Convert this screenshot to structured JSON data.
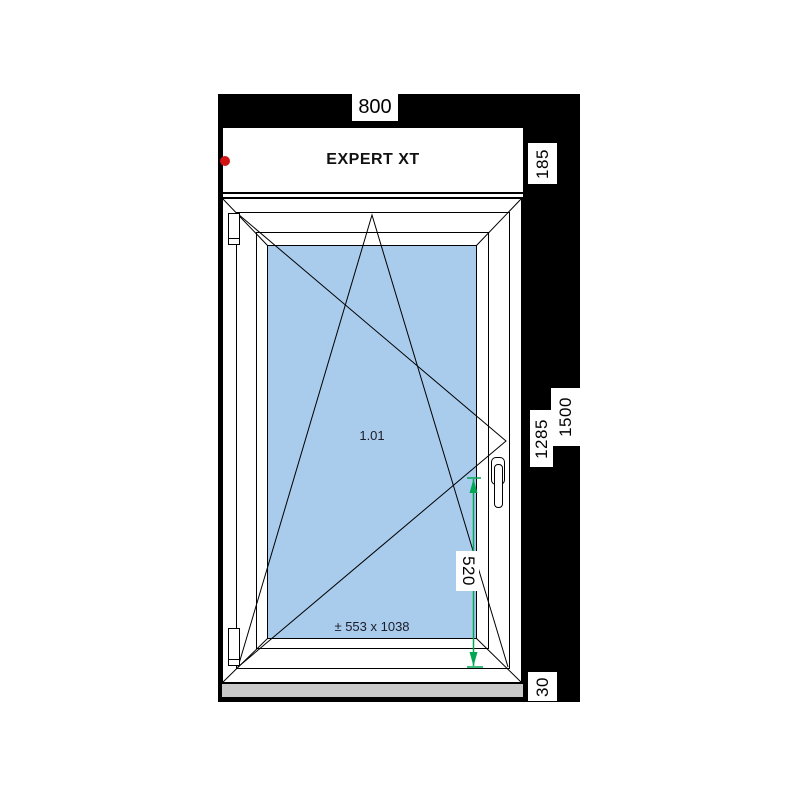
{
  "drawing": {
    "profile_name": "EXPERT XT",
    "position_number": "1.01",
    "glass_size_label": "± 553 x 1038"
  },
  "dimensions": {
    "frame_width": "800",
    "top_box_height": "185",
    "total_height": "1500",
    "window_height": "1285",
    "handle_height": "520",
    "sill_height": "30"
  },
  "icons": {
    "marker": "red-dot",
    "handle": "window-handle",
    "hinges": "hinge-plates",
    "opening_symbols": "tilt-and-turn-lines",
    "green_dimension": "handle-height-arrow"
  },
  "colors": {
    "glass": "#A9CBEC",
    "masonry": "#000000",
    "sill": "#C9C9C9",
    "marker_dot": "#D11414",
    "dimension_green": "#00A651"
  }
}
